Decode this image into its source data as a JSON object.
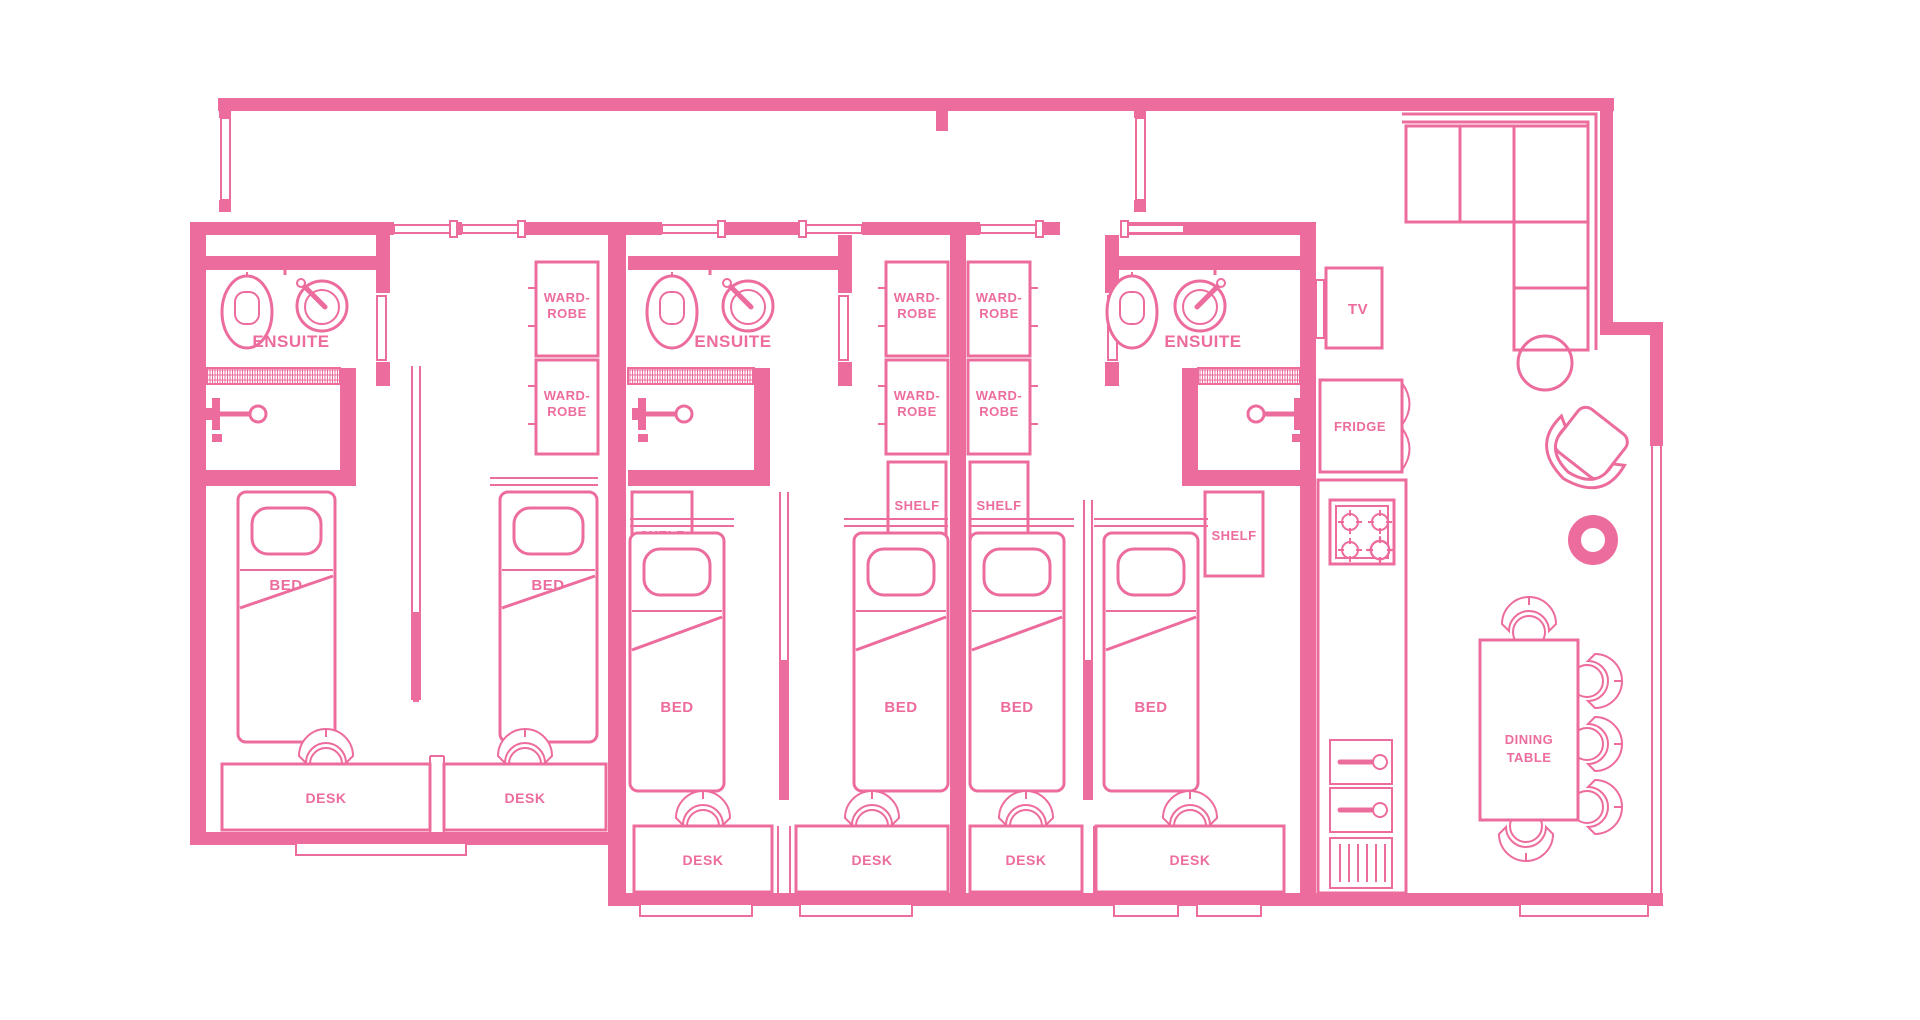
{
  "palette": {
    "pink": "#ED6C9E",
    "background": "#FFFFFF"
  },
  "plan": {
    "type": "student-apartment-floor-plan",
    "labels": {
      "ensuite": "ENSUITE",
      "wardrobe_line1": "WARD-",
      "wardrobe_line2": "ROBE",
      "shelf": "SHELF",
      "bed": "BED",
      "desk": "DESK",
      "tv": "TV",
      "fridge": "FRIDGE",
      "dining_line1": "DINING",
      "dining_line2": "TABLE"
    },
    "rooms": [
      {
        "name": "bedroom-1",
        "features": [
          "ENSUITE",
          "BED",
          "DESK"
        ]
      },
      {
        "name": "bedroom-2",
        "features": [
          "WARD-ROBE",
          "WARD-ROBE",
          "BED",
          "DESK"
        ]
      },
      {
        "name": "bedroom-3",
        "features": [
          "ENSUITE",
          "SHELF",
          "BED",
          "DESK"
        ]
      },
      {
        "name": "bedroom-4",
        "features": [
          "WARD-ROBE",
          "WARD-ROBE",
          "SHELF",
          "BED",
          "DESK"
        ]
      },
      {
        "name": "bedroom-5",
        "features": [
          "WARD-ROBE",
          "WARD-ROBE",
          "SHELF",
          "BED",
          "DESK"
        ]
      },
      {
        "name": "bedroom-6",
        "features": [
          "ENSUITE",
          "SHELF",
          "BED",
          "DESK"
        ]
      }
    ],
    "kitchen_living": {
      "labeled_features": [
        "TV",
        "FRIDGE",
        "DINING TABLE"
      ],
      "unlabeled_features": [
        "corner-sofa",
        "armchair",
        "side-table",
        "floor-cushion",
        "hob",
        "double-sink",
        "drainer",
        "dining-chairs"
      ]
    }
  }
}
